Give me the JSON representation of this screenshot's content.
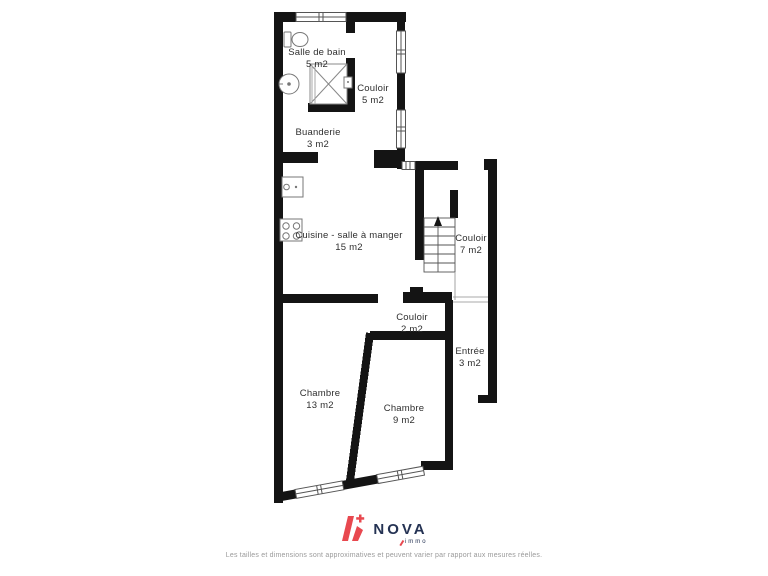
{
  "colors": {
    "wall": "#141414",
    "accent": "#E8484F",
    "navy": "#243253",
    "label": "#2F2F2F",
    "fixture": "#777777",
    "frame": "#555555",
    "muted": "#9A9A9A"
  },
  "rooms": {
    "salle_de_bain": {
      "name": "Salle de bain",
      "area": "5 m2"
    },
    "couloir_haut": {
      "name": "Couloir",
      "area": "5 m2"
    },
    "buanderie": {
      "name": "Buanderie",
      "area": "3 m2"
    },
    "cuisine": {
      "name": "Cuisine - salle à manger",
      "area": "15 m2"
    },
    "couloir_escalier": {
      "name": "Couloir",
      "area": "7 m2"
    },
    "couloir_bas": {
      "name": "Couloir",
      "area": "2 m2"
    },
    "entree": {
      "name": "Entrée",
      "area": "3 m2"
    },
    "chambre_1": {
      "name": "Chambre",
      "area": "13 m2"
    },
    "chambre_2": {
      "name": "Chambre",
      "area": "9 m2"
    }
  },
  "logo": {
    "brand": "NOVA",
    "sub": "immo"
  },
  "footer": {
    "disclaimer": "Les tailles et dimensions sont approximatives et peuvent varier par rapport aux mesures réelles."
  }
}
